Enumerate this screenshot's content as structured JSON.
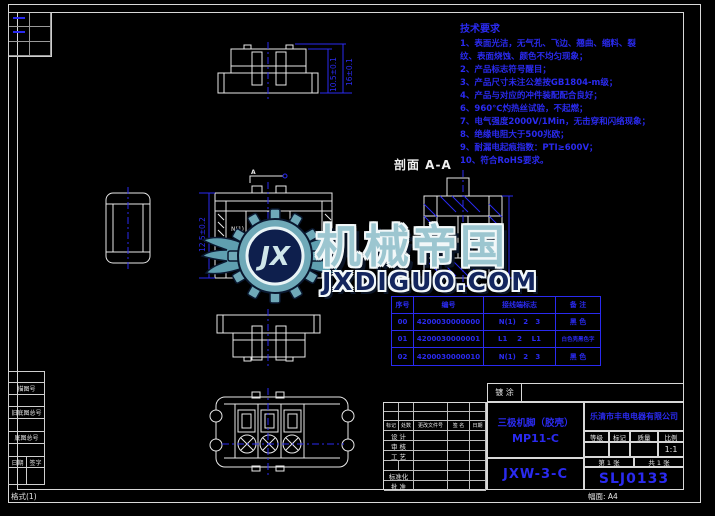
{
  "colors": {
    "line_blue": "#2a2af0",
    "line_white": "#e8e8e8",
    "logo_teal": "#6fa9b8",
    "logo_navy": "#0e1f4d"
  },
  "notes": {
    "title": "技术要求",
    "lines": [
      "1、表面光洁，无气孔、飞边、翘曲、缩料、裂",
      "纹、表面烧蚀、颜色不均匀现象；",
      "2、产品标志符号醒目；",
      "3、产品尺寸未注公差按GB1804-m级；",
      "4、产品与对应的冲件装配配合良好；",
      "6、960℃灼热丝试验，不起燃；",
      "7、电气强度2000V/1Min，无击穿和闪络现象；",
      "8、绝缘电阻大于500兆欧；",
      "9、耐漏电起痕指数：PTI≥600V；",
      "10、符合RoHS要求。"
    ]
  },
  "section_label": "剖面 A-A",
  "watermark": {
    "brand": "机械帝国",
    "site": "JXDIGUO.COM",
    "monogram": "JX"
  },
  "variant_table": {
    "headers": [
      "序号",
      "编号",
      "接线端标志",
      "备 注"
    ],
    "rows": [
      [
        "00",
        "4200030000000",
        "N(1)   2   3",
        "黑 色"
      ],
      [
        "01",
        "4200030000001",
        "L1    2    L1",
        "白色壳黑色字"
      ],
      [
        "02",
        "4200030000010",
        "N(1)   2   3",
        "黑 色"
      ]
    ]
  },
  "title_block": {
    "coating": "镀 涂",
    "product_name": "三极机脚（胶壳）",
    "product_model": "MP11-C",
    "company": "乐清市丰电电器有限公司",
    "model_code": "JXW-3-C",
    "drawing_no": "SLJ0133",
    "meta_headers": [
      "等级",
      "标记",
      "质量",
      "比例"
    ],
    "scale": "1:1",
    "sheet_no": "第 1 张",
    "sheet_total": "共 1 张",
    "rev_headers": [
      "标记",
      "处数",
      "更改文件号",
      "签 名",
      "日期"
    ],
    "roles": [
      "设 计",
      "审 核",
      "工 艺",
      "标准化",
      "批 准"
    ]
  },
  "margin_strip": {
    "rows": [
      "描图号",
      "旧底图总号",
      "底图总号"
    ],
    "sign_cells": [
      "日期",
      "签字"
    ],
    "format_label": "格式(1)",
    "sheet_size_label": "幅面: A4"
  },
  "dims": {
    "top1": "10.5±0.1",
    "top2": "16±0.1",
    "front1": "12.5±0.2",
    "n1": "N(1)",
    "t2": "2",
    "t3": "3",
    "a": "A"
  }
}
